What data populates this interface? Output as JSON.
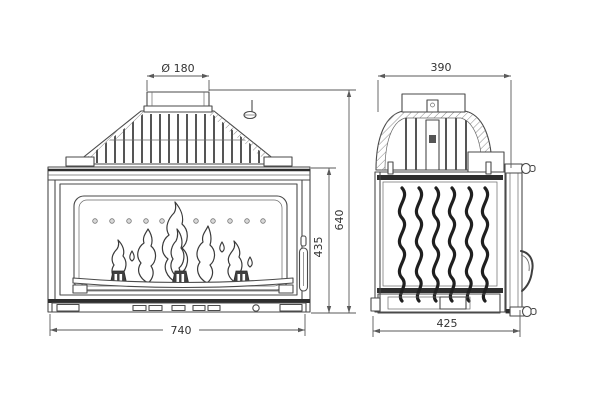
{
  "drawing": {
    "subject": "fireplace-insert-two-view-technical-drawing",
    "colors": {
      "background": "#ffffff",
      "line": "#4a4a4a",
      "dark_bands": "#2e2e2e",
      "dimension_lines": "#5a5a5a",
      "text": "#333333"
    },
    "views": {
      "front": {
        "label": "front-view"
      },
      "side": {
        "label": "side-view"
      }
    },
    "dims": {
      "flue_diameter": "Ø 180",
      "side_top_width": "390",
      "overall_height": "640",
      "firebox_height": "435",
      "front_width": "740",
      "depth": "425"
    }
  }
}
